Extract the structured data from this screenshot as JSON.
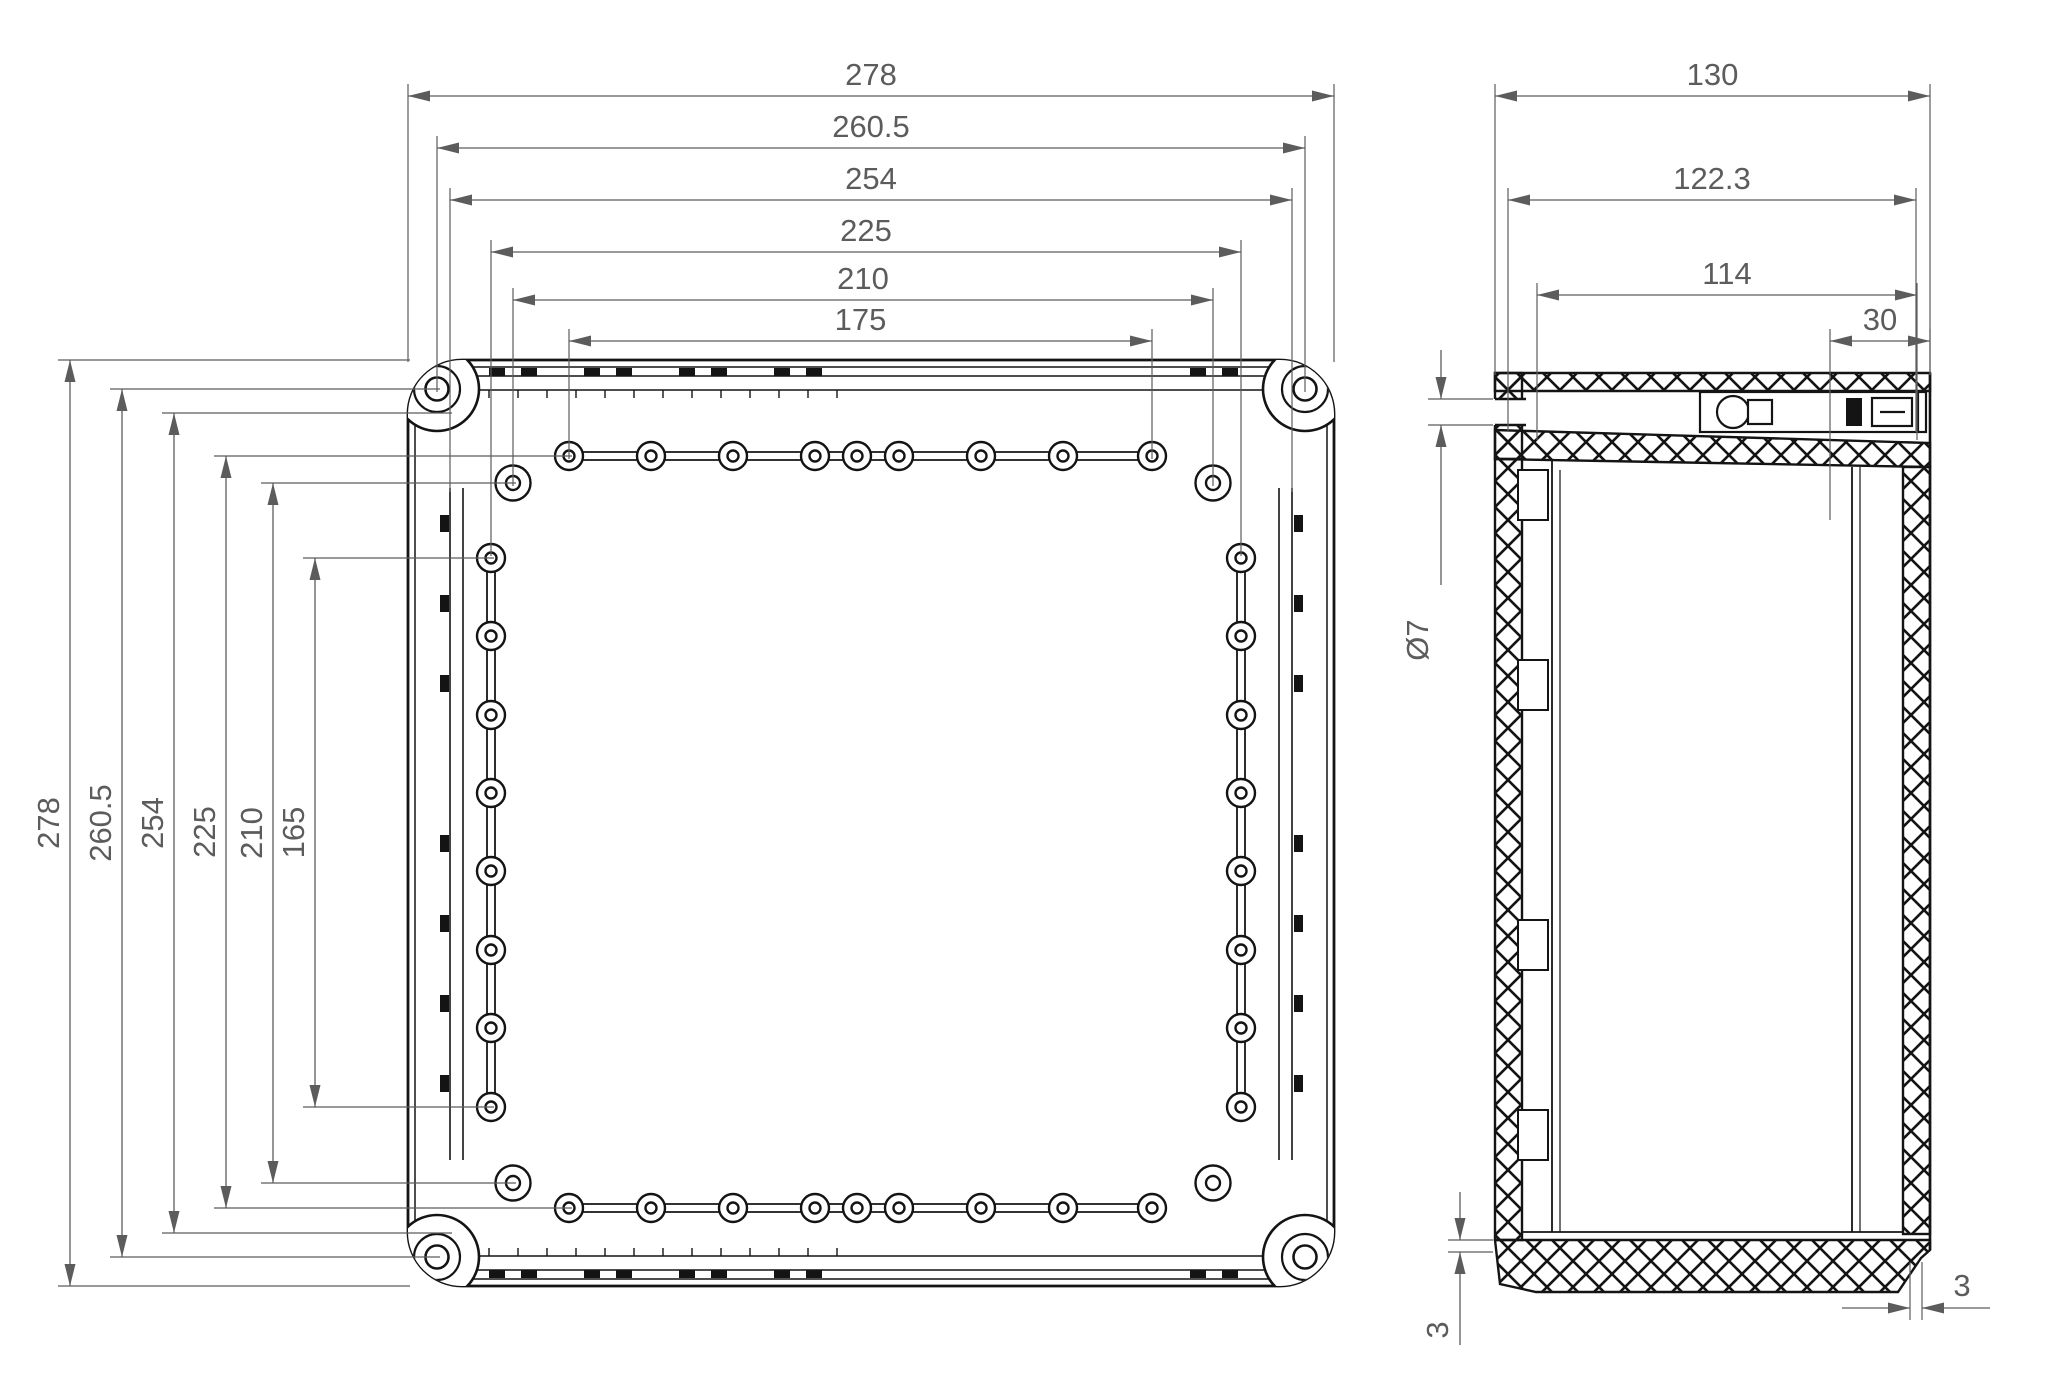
{
  "drawing": {
    "type": "technical-dimension-drawing",
    "units": "mm",
    "views": {
      "front": {
        "name": "enclosure-front-view",
        "dims_top": [
          "278",
          "260.5",
          "254",
          "225",
          "210",
          "175"
        ],
        "dims_left": [
          "278",
          "260.5",
          "254",
          "225",
          "210",
          "165"
        ],
        "holes": {
          "corner_screw_holes": 4,
          "inner_corner_bosses": 4,
          "top_row_bosses": 9,
          "bottom_row_bosses": 9,
          "left_column_bosses": 8,
          "right_column_bosses": 8
        }
      },
      "side": {
        "name": "enclosure-side-section-view",
        "dims_top": [
          "130",
          "122.3",
          "114",
          "30"
        ],
        "hole_diameter_label": "Ø7",
        "wall_thickness_bottom_left": "3",
        "wall_thickness_bottom_right": "3"
      }
    },
    "colors": {
      "geometry_line": "#141414",
      "dimension_line": "#5c5c5c",
      "background": "#ffffff"
    }
  }
}
